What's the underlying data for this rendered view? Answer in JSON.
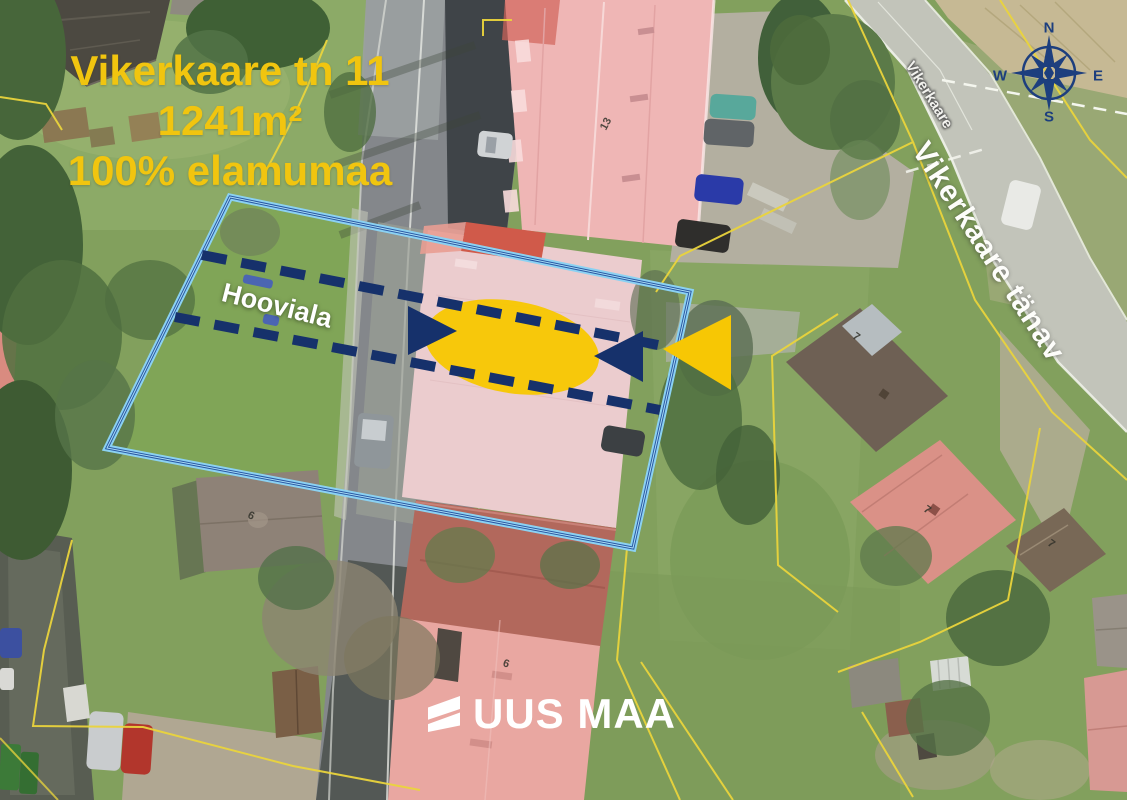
{
  "map": {
    "title": {
      "line1": "Vikerkaare tn 11",
      "line2": "1241m²",
      "line3": "100% elamumaa",
      "color": "#f1c50f"
    },
    "labels": {
      "yard": "Hooviala",
      "street_small": "Vikerkaare",
      "street_large": "Vikerkaare tänav"
    },
    "house_numbers": {
      "top_building": "13",
      "left_house": "6",
      "bottom_building": "6",
      "right_house_a": "7",
      "right_house_b": "7",
      "right_house_c": "7"
    },
    "compass": {
      "n": "N",
      "e": "E",
      "s": "S",
      "w": "W",
      "color": "#1d3f7e"
    },
    "logo": {
      "text": "UUS MAA"
    },
    "colors": {
      "overlay_navy": "#16316b",
      "overlay_yellow": "#f7c704",
      "parcel_light_blue": "#8bd1f2",
      "parcel_navy": "#2a58a4",
      "cadastral_yellow": "#ead43c"
    }
  }
}
